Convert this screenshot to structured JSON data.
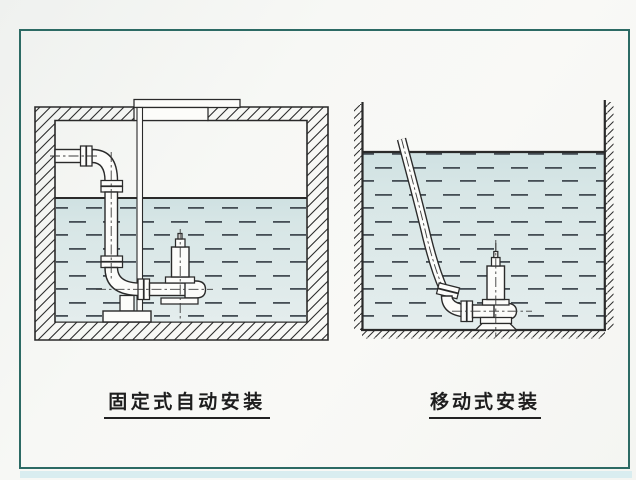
{
  "diagrams": {
    "fixed": {
      "label": "固定式自动安装"
    },
    "mobile": {
      "label": "移动式安装"
    }
  },
  "colors": {
    "frame-teal": "#2c6a64",
    "ink": "#1e1e1e",
    "line-ink": "#2a2a2a",
    "water-fill-light": "#e2ecec",
    "water-fill-dark": "#cfe1e2",
    "water-dash": "#454e55",
    "paper": "#f8f8f5",
    "bottom-strip": "#d9edf0"
  }
}
